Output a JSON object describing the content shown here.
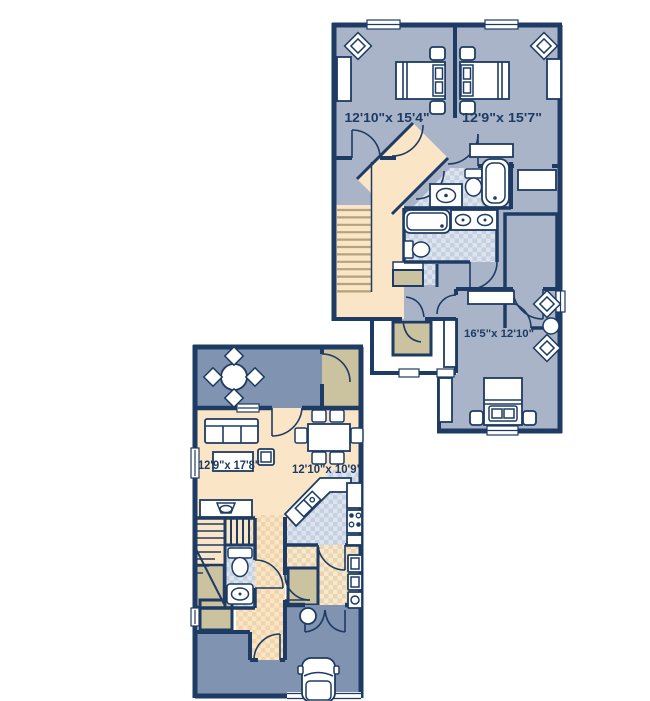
{
  "page": {
    "type": "floor-plan",
    "description": "Two-level townhome floor plan with upper bedroom level and lower living level",
    "background": "#ffffff"
  },
  "palette": {
    "wall": "#1d3b63",
    "room_fill": "#a9b4c9",
    "outdoor_fill": "#8093b1",
    "hallway_fill": "#fbe5c7",
    "closet_fill": "#cbc29f",
    "bath_tile": "#c5d1e1",
    "bath_tile_alt": "#dde4ee",
    "laundry_tile": "#ead5ae",
    "text": "#1d3b63"
  },
  "upper_floor": {
    "title": "upper-floor",
    "rooms": [
      {
        "id": "bedroom-1",
        "dimensions": "12'10\"x 15'4\""
      },
      {
        "id": "bedroom-2",
        "dimensions": "12'9\"x 15'7\""
      },
      {
        "id": "bedroom-3",
        "dimensions": "16'5\"x 12'10\""
      }
    ],
    "features": [
      "two baths with tubs",
      "walk-in closets",
      "staircase",
      "diagonal hallway"
    ]
  },
  "lower_floor": {
    "title": "lower-floor",
    "rooms": [
      {
        "id": "living-room",
        "dimensions": "12'9\"x 17'8\""
      },
      {
        "id": "dining-kitchen",
        "dimensions": "12'10\"x 10'9\""
      }
    ],
    "features": [
      "patio with table",
      "kitchen with island",
      "powder room",
      "laundry",
      "garage with car"
    ]
  }
}
